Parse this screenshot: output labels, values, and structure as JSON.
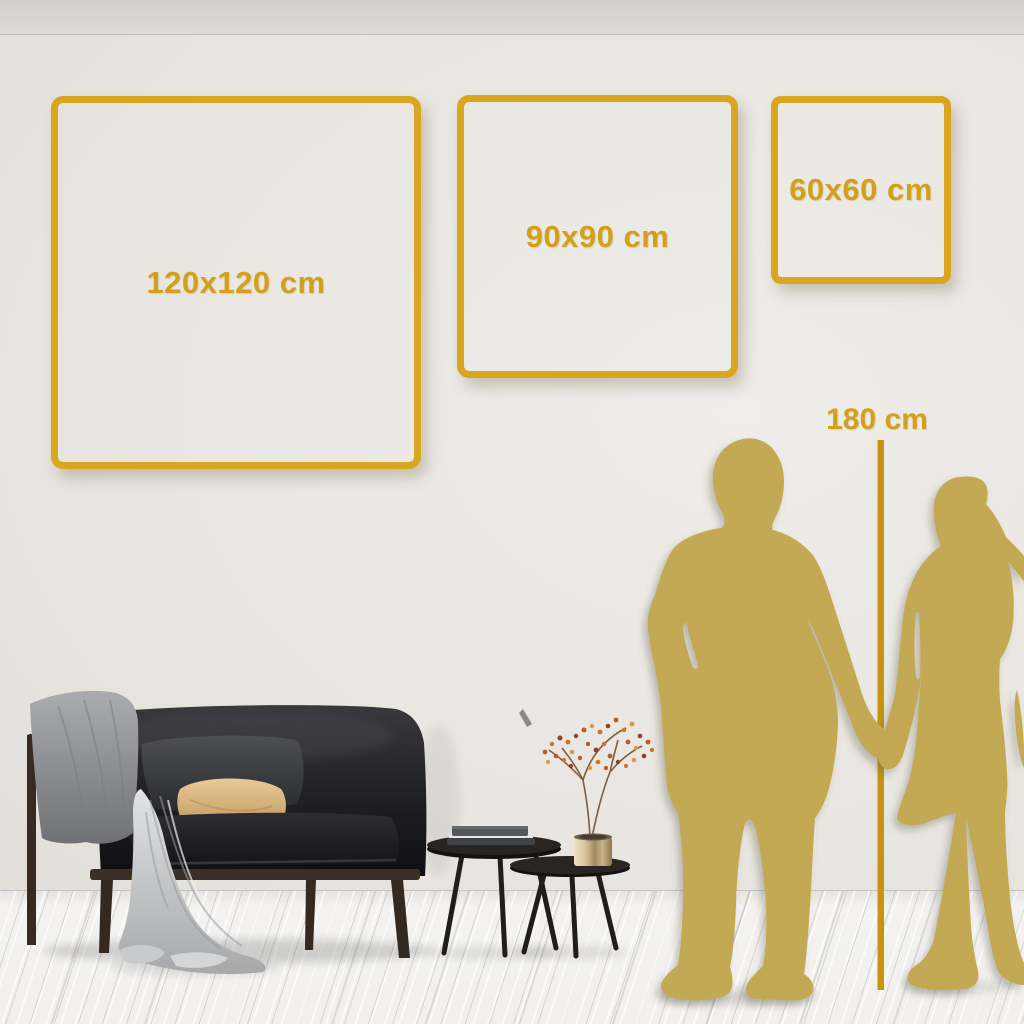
{
  "size_guide": {
    "frames": [
      {
        "label": "120x120 cm"
      },
      {
        "label": "90x90 cm"
      },
      {
        "label": "60x60 cm"
      }
    ],
    "height_reference": {
      "label": "180 cm"
    }
  },
  "colors": {
    "frame_gold": "#D8A71F",
    "label_gold": "#D2A01A",
    "line_gold": "#C6940E",
    "silhouette_gold": "#C3A952",
    "wall_light": "#EFEDE9",
    "wall_dark": "#D9D6CF",
    "floor": "#F2F1EF"
  },
  "scene": {
    "elements": [
      "sofa-with-blanket",
      "nesting-coffee-tables",
      "books-stack",
      "brass-vase-with-branch",
      "couple-silhouette",
      "height-reference-line"
    ]
  }
}
